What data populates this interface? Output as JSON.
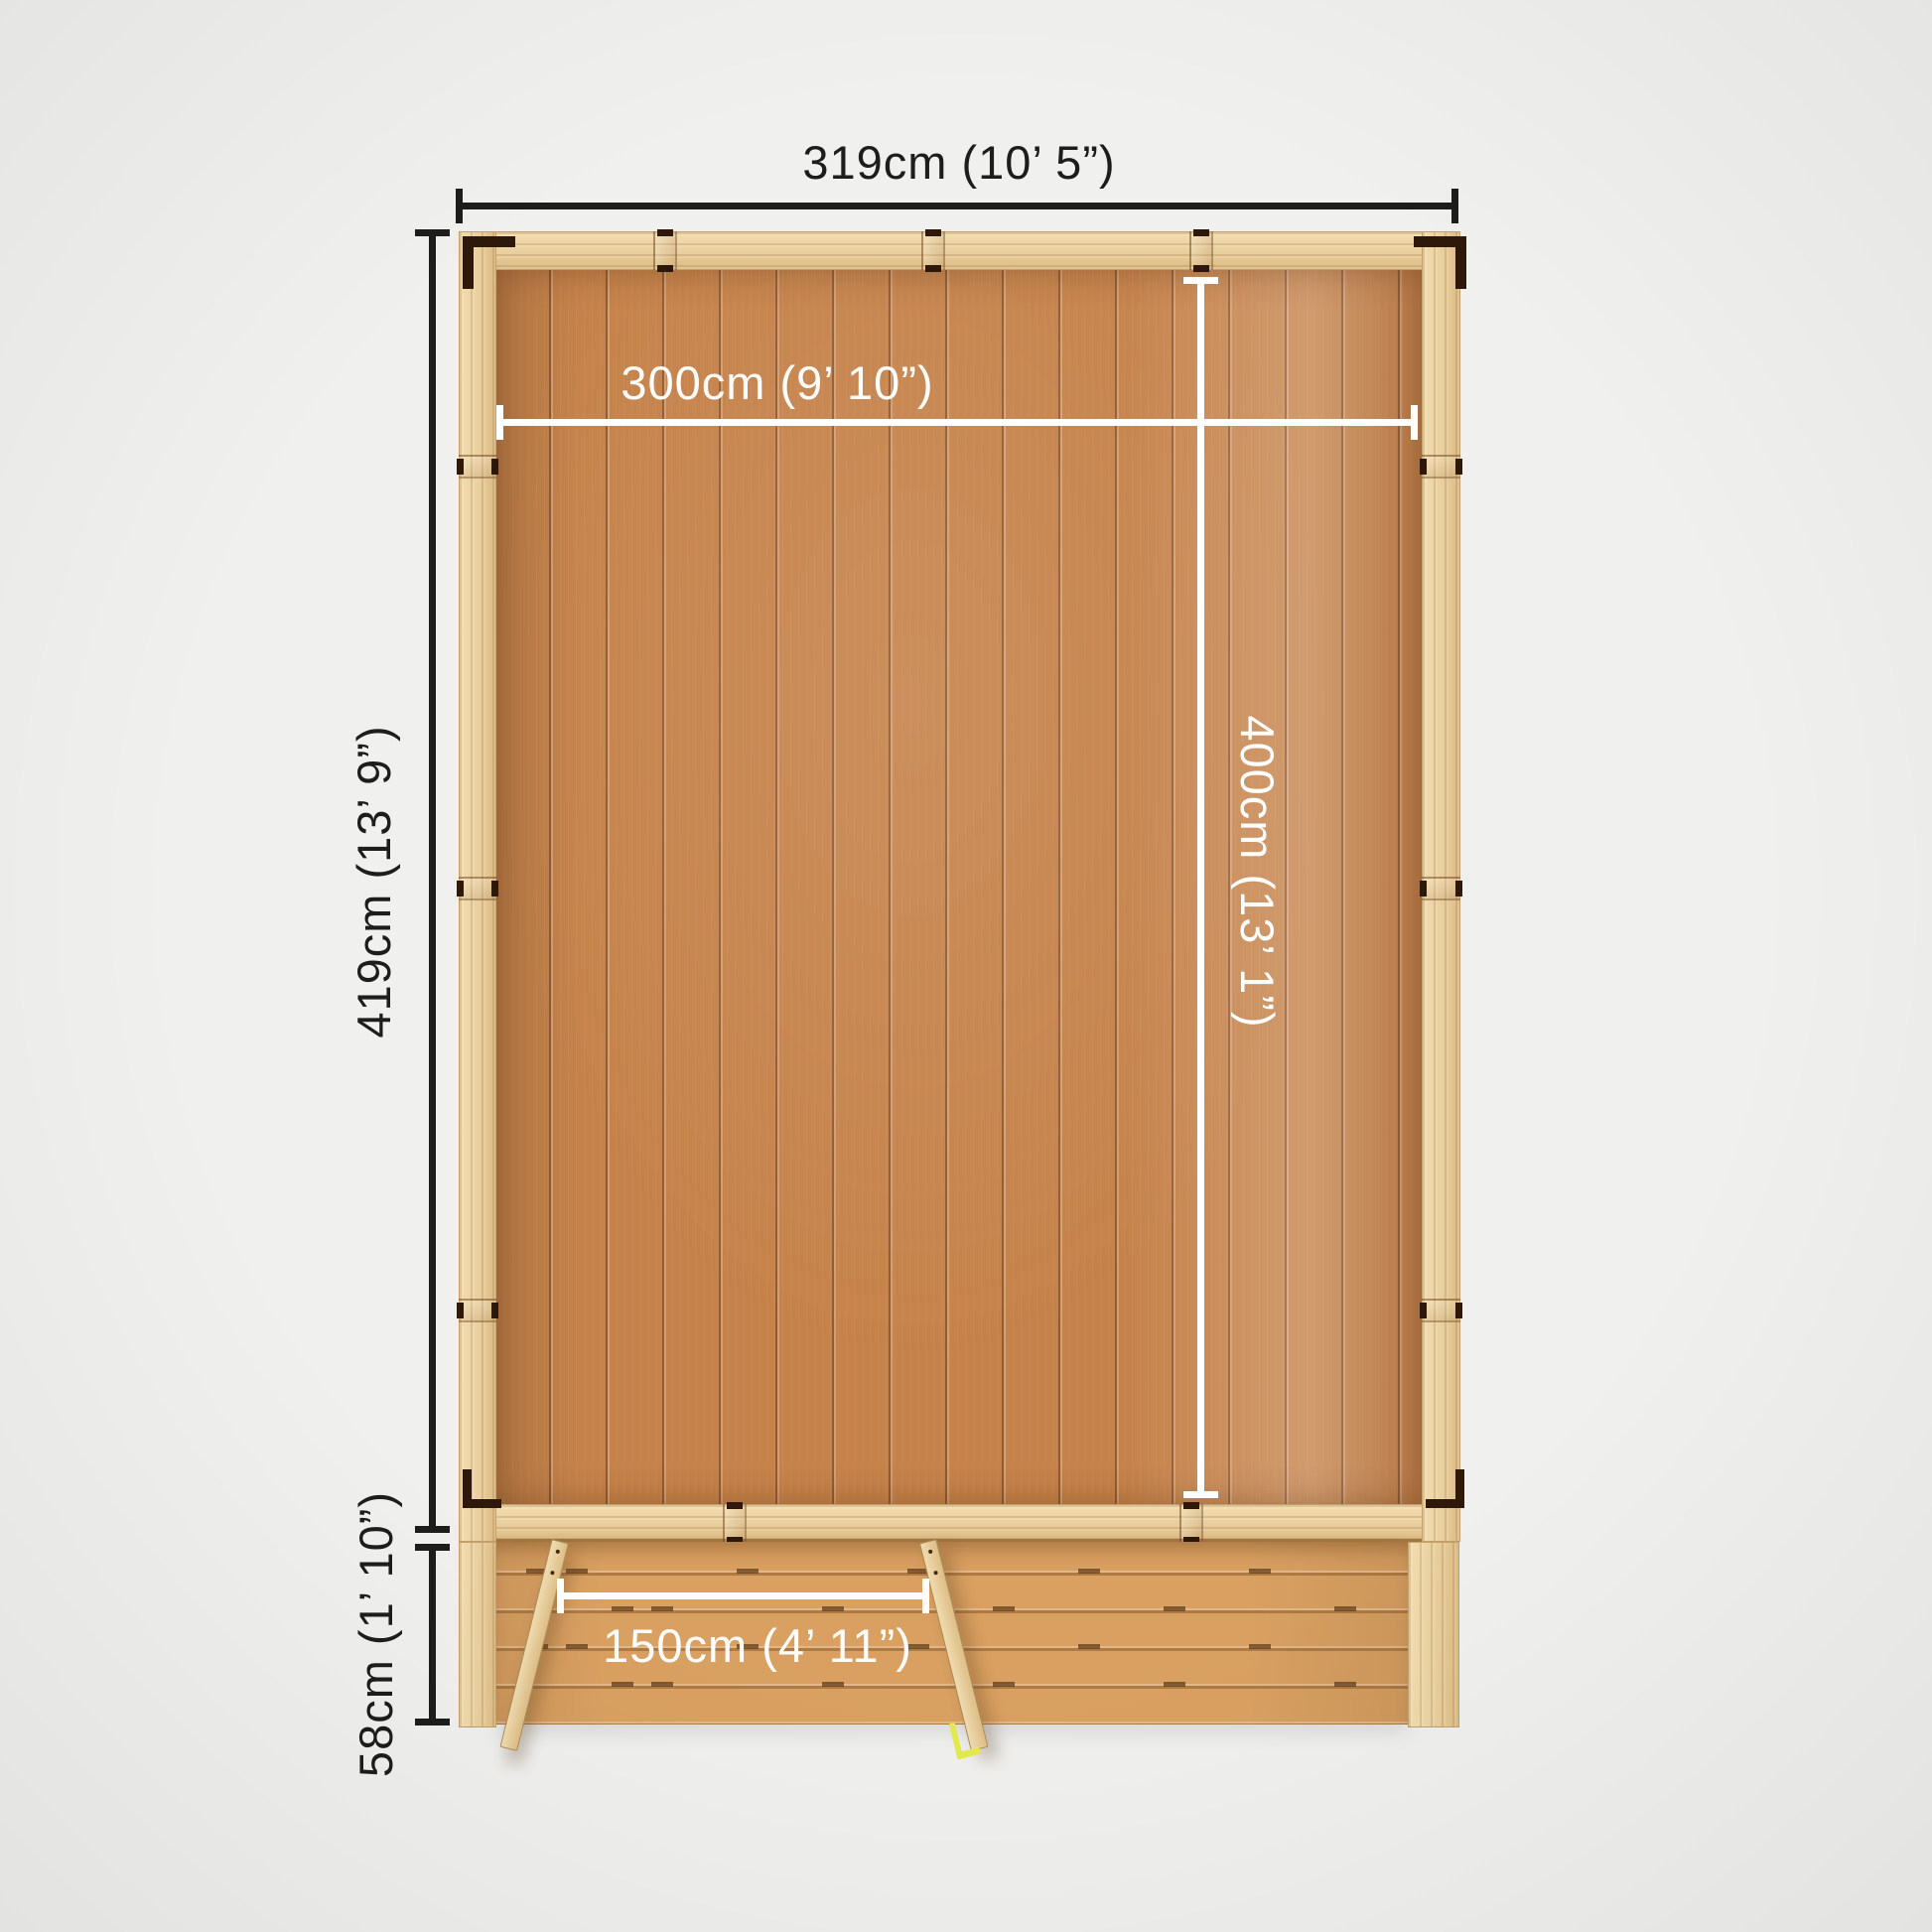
{
  "diagram": {
    "description": "Top-down plan view of a wooden garden building with veranda decking and open double doors, annotated with dimensions",
    "annotations": {
      "overall_width": {
        "label": "319cm (10’ 5”)",
        "style": "black"
      },
      "overall_depth": {
        "label": "419cm (13’ 9”)",
        "style": "black"
      },
      "veranda_depth": {
        "label": "58cm (1’ 10”)",
        "style": "black"
      },
      "internal_width": {
        "label": "300cm (9’ 10”)",
        "style": "white"
      },
      "internal_depth": {
        "label": "400cm (13’ 1”)",
        "style": "white"
      },
      "door_opening": {
        "label": "150cm (4’ 11”)",
        "style": "white"
      }
    },
    "colors": {
      "background": "#f0f0ee",
      "pine_frame": "#e9cf9e",
      "interior_floor": "#c5824a",
      "decking": "#d9a061",
      "dimension_black": "#1d1d1b",
      "dimension_white": "#ffffff",
      "corner_bracket": "#2d1809",
      "door_handle": "#e3e94f"
    }
  }
}
